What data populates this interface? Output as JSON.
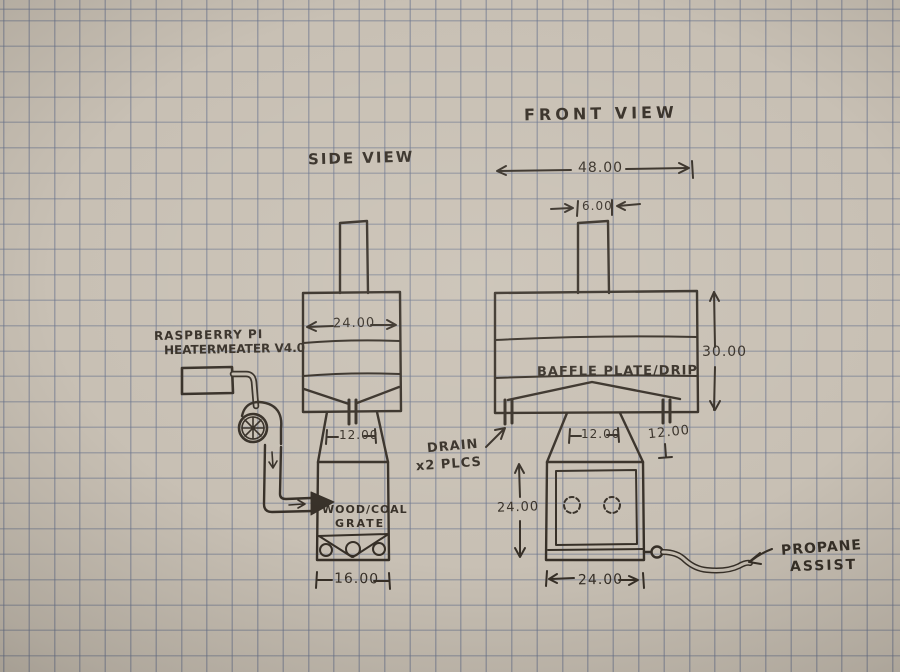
{
  "sketch": {
    "side_view": {
      "title": "SIDE VIEW",
      "dim_body_width": "24.00",
      "dim_opening_width": "12.00",
      "dim_firebox_width": "16.00",
      "grate_line1": "WOOD/COAL",
      "grate_line2": "GRATE"
    },
    "front_view": {
      "title": "FRONT VIEW",
      "dim_overall_width": "48.00",
      "dim_chimney_width": "6.00",
      "dim_body_height": "30.00",
      "dim_opening_width": "12.00",
      "dim_transition_height": "12.00",
      "dim_firebox_height": "24.00",
      "dim_firebox_width": "24.00",
      "baffle_label": "BAFFLE PLATE/DRIP"
    },
    "annotations": {
      "controller_line1": "RASPBERRY PI",
      "controller_line2": "HEATERMEATER V4.0",
      "drain_line1": "DRAIN",
      "drain_line2": "x2 PLCS",
      "propane_line1": "PROPANE",
      "propane_line2": "ASSIST"
    },
    "colors": {
      "ink": "#362f27",
      "paper": "#c8c0b4",
      "grid_line": "#68728c"
    }
  }
}
